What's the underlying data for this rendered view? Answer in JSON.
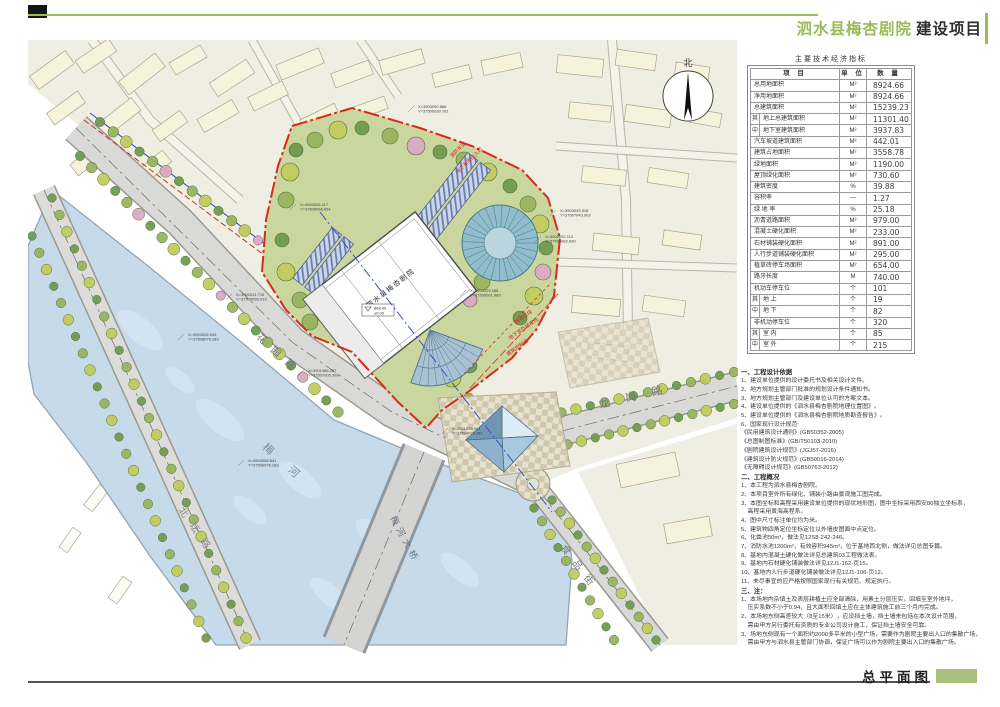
{
  "title_block": {
    "project_green": "泗水县梅杏剧院",
    "project_dark": "建设项目"
  },
  "footer": {
    "label": "总平面图"
  },
  "colors": {
    "accent_green": "#9cba57",
    "bar_green": "#a9c17c",
    "red_line": "#d62b1f",
    "water": "#c6daea"
  },
  "table": {
    "title": "主要技术经济指标",
    "headers": {
      "item": "项  目",
      "unit": "单 位",
      "qty": "数  量"
    },
    "rows": [
      {
        "g": "",
        "item": "总用地面积",
        "unit": "M²",
        "qty": "8924.66"
      },
      {
        "g": "",
        "item": "净用地面积",
        "unit": "M²",
        "qty": "8924.66"
      },
      {
        "g": "",
        "item": "总建筑面积",
        "unit": "M²",
        "qty": "15239.23"
      },
      {
        "g": "其",
        "item": "地上总建筑面积",
        "unit": "M²",
        "qty": "11301.40"
      },
      {
        "g": "中",
        "item": "地下室建筑面积",
        "unit": "M²",
        "qty": "3937.83"
      },
      {
        "g": "",
        "item": "汽车坡道建筑面积",
        "unit": "M²",
        "qty": "442.01"
      },
      {
        "g": "",
        "item": "建筑占地面积",
        "unit": "M²",
        "qty": "3558.78"
      },
      {
        "g": "",
        "item": "绿地面积",
        "unit": "M²",
        "qty": "1190.00"
      },
      {
        "g": "",
        "item": "屋顶绿化面积",
        "unit": "M²",
        "qty": "730.60"
      },
      {
        "g": "",
        "item": "建筑密度",
        "unit": "%",
        "qty": "39.88"
      },
      {
        "g": "",
        "item": "容积率",
        "unit": "—",
        "qty": "1.27"
      },
      {
        "g": "",
        "item": "绿 地 率",
        "unit": "%",
        "qty": "25.18"
      },
      {
        "g": "",
        "item": "沥青道路面积",
        "unit": "M²",
        "qty": "979.00"
      },
      {
        "g": "",
        "item": "混凝土硬化面积",
        "unit": "M²",
        "qty": "233.00"
      },
      {
        "g": "",
        "item": "石材铺装硬化面积",
        "unit": "M²",
        "qty": "891.00"
      },
      {
        "g": "",
        "item": "人行步道铺装硬化面积",
        "unit": "M²",
        "qty": "295.00"
      },
      {
        "g": "",
        "item": "植草砖停车场面积",
        "unit": "M²",
        "qty": "654.00"
      },
      {
        "g": "",
        "item": "路牙长度",
        "unit": "M",
        "qty": "740.00"
      },
      {
        "g": "",
        "item": "机动车停车位",
        "unit": "个",
        "qty": "101"
      },
      {
        "g": "其",
        "item": "地  上",
        "unit": "个",
        "qty": "19"
      },
      {
        "g": "中",
        "item": "地  下",
        "unit": "个",
        "qty": "82"
      },
      {
        "g": "",
        "item": "非机动停车位",
        "unit": "个",
        "qty": "320"
      },
      {
        "g": "其",
        "item": "室  内",
        "unit": "个",
        "qty": "85"
      },
      {
        "g": "中",
        "item": "室  外",
        "unit": "个",
        "qty": "215"
      }
    ]
  },
  "notes": {
    "sections": [
      {
        "heading": "一、工程设计依据",
        "lines": [
          "1、建设单位提供的设计委托书及相关设计文件。",
          "2、地方规划主管部门批准的规划设计条件通知书。",
          "3、地方规划主管部门及建设单位认可的方案文本。",
          "4、建设单位提供的《泗水县梅杏剧院地理位置图》。",
          "5、建设单位提供的《泗水县梅杏剧院地质勘查报告》。",
          "6、国家现行设计规范:",
          "《民用建筑设计通则》(GB50352-2005)",
          "《总图制图标准》(GB/T50103-2010)",
          "《剧院建筑设计规范》(JGJ57-2016)",
          "《建筑设计防火规范》(GB50016-2014)",
          "《无障碍设计规范》(GB50763-2012)"
        ]
      },
      {
        "heading": "二、工程概况",
        "lines": [
          "1、本工程为泗水县梅杏剧院。",
          "2、本项目室外所有绿化、铺装小路由景观施工图完成。",
          "3、本图坐标和高程采用建设单位提供的现状地形图，图中坐标采用西安80独立坐标系，",
          "    高程采用黄海高程系。",
          "4、图中尺寸标注单位均为米。",
          "5、建筑物四角定位坐标定位以外墙皮图面中点定位。",
          "6、化粪池50m³，做法见12S8-242-246。",
          "7、消防水池1200m³，有效容积945m³，位于基地西北侧，做法详见总图专篇。",
          "8、基地内混凝土硬化做法详见总建筑03工程做法表。",
          "9、基地内石材硬化铺装做法详见12J1-162-页15。",
          "10、基地内人行步道硬化铺装做法详见12J1-106-页12。",
          "11、未尽事宜的应严格按照国家现行有关规范、规定执行。"
        ]
      },
      {
        "heading": "三、注：",
        "lines": [
          "1、本场地内杂填土及表层耕植土应全部清除，用素土分层压实，回填至室外地坪，",
          "    压实系数不小于0.94，且大面积回填土应在主体建筑施工前三个月内完成。",
          "2、本场地东侧高差较大（8至15米），应设挡土墙，挡土墙未包括在本次设计范围，",
          "    需由甲方另行委托有资质的专业公司设计施工，保证挡土墙安全可靠。",
          "3、场地东侧现有一个面积约2000多平米的小型广场，需要作为剧院主要出入口的集散广场，",
          "    需由甲方与泗水县主管部门协调，保证广场可以作为剧院主要出入口的集散广场。"
        ]
      }
    ]
  },
  "map": {
    "north_label": "北",
    "building_label": "泗水县梅杏剧院",
    "elevation_top": "868.40",
    "elevation_bottom": "±0.00",
    "roads": {
      "north": "北坛路",
      "river": "梅 河",
      "bridge": "梅河大桥",
      "garden": "花园路",
      "longgang": "龙岗路",
      "food": "食品街"
    },
    "red_annotations": [
      "用地红线",
      "地下室外墙皮线",
      "建筑控制线",
      "消防车道",
      "地下车库出入口"
    ],
    "coordinate_labels": [
      [
        "X=3903026.117",
        "Y=37506066.694"
      ],
      [
        "X=3903090.886",
        "Y=37506030.781"
      ],
      [
        "X=3903043.518",
        "Y=37507043.903"
      ],
      [
        "X=3902022.112",
        "Y=37506082.930"
      ],
      [
        "X=3902031.716",
        "Y=37506065.913"
      ],
      [
        "X=3903026.945",
        "Y=37508076.183"
      ],
      [
        "X=3901986.207",
        "Y=37507005.309"
      ],
      [
        "X=3901973.901",
        "Y=37504023.381"
      ],
      [
        "X=3903008.841",
        "Y=37506076.183"
      ],
      [
        "X=3903029.188",
        "Y=37506061.089"
      ]
    ]
  }
}
